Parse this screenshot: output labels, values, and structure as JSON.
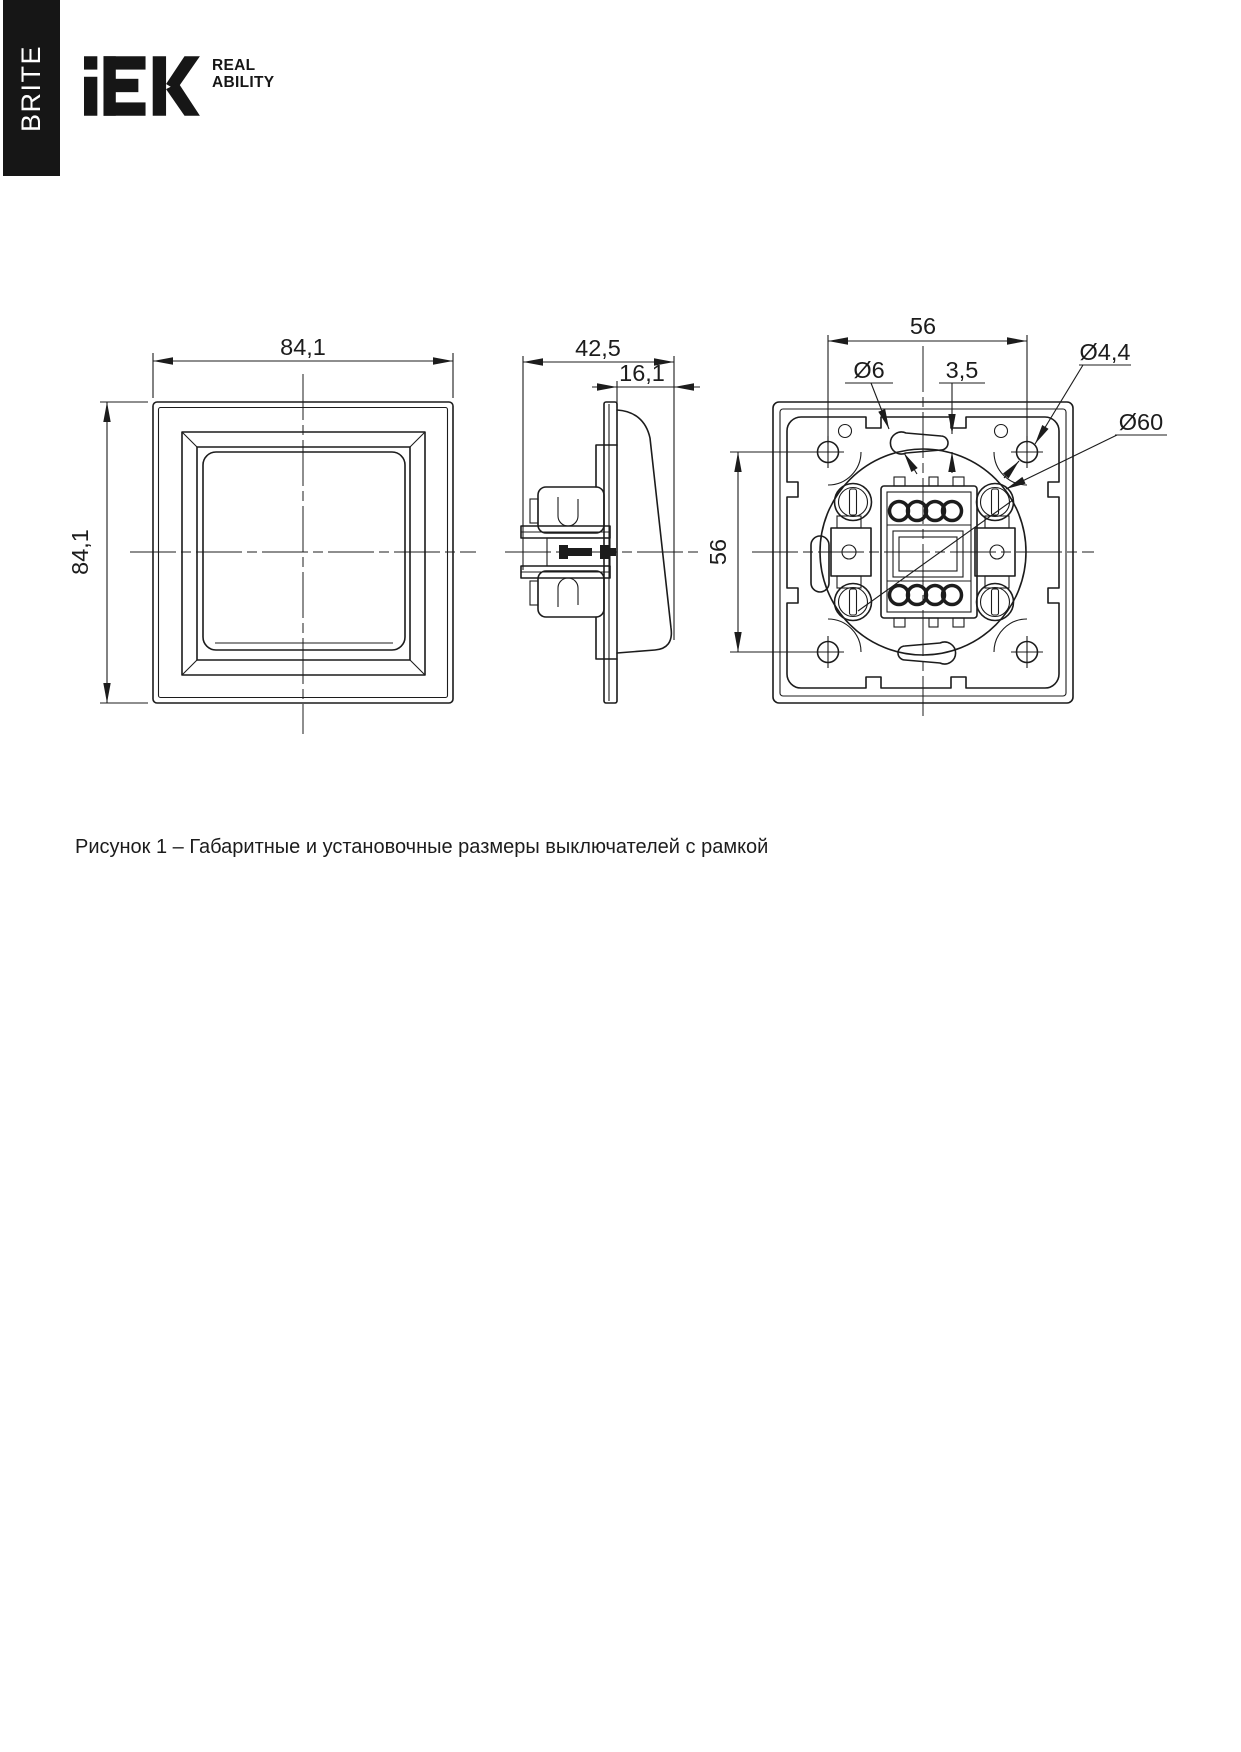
{
  "brand": {
    "product_line": "BRITE",
    "logo": "IEK",
    "tagline1": "REAL",
    "tagline2": "ABILITY"
  },
  "figure": {
    "caption": "Рисунок 1 – Габаритные и установочные размеры выключателей с рамкой"
  },
  "dimensions": {
    "front_width": "84,1",
    "front_height": "84,1",
    "side_depth": "42,5",
    "side_protrusion": "16,1",
    "back_hole_spacing_h": "56",
    "back_hole_spacing_v": "56",
    "slot_diameter": "Ø6",
    "slot_width": "3,5",
    "mount_hole_diameter": "Ø4,4",
    "installation_diameter": "Ø60"
  },
  "colors": {
    "ink": "#1c1c1c",
    "bar": "#161616"
  }
}
